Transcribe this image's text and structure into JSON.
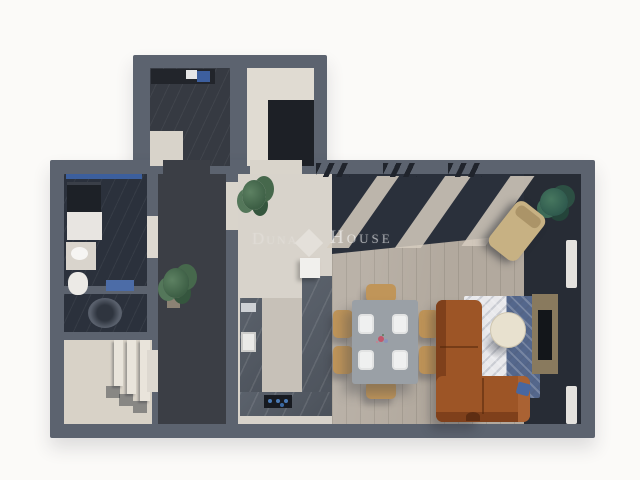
{
  "watermark": {
    "prefix_text": "Duna",
    "logo": "diamond-icon",
    "brand_text": "House"
  },
  "palette": {
    "background": "#fbfaf8",
    "wall": "#5c636f",
    "wood_floor": "#b2a99e",
    "dark_tile_floor": "#2b313c",
    "hallway_floor": "#3b3e45",
    "light_floor": "#d8d2c7",
    "kitchen_counter": "#565d66",
    "sofa_leather": "#9d5526",
    "rug_blue": "#54678c",
    "rug_white": "#e9e9ec",
    "chair_wood": "#c09559",
    "window_accent_blue": "#3c5f9d",
    "plant_green": "#4e7052"
  },
  "rooms": [
    "storage-room",
    "wardrobe-room",
    "bathroom",
    "wc",
    "entry-with-stairs",
    "hallway",
    "kitchen",
    "living-dining-area",
    "terrace-shadow-band"
  ],
  "furniture": [
    "washing-machine",
    "dryer",
    "bath-counter-sink",
    "toilet",
    "staircase",
    "potted-plants",
    "u-shaped-kitchen-counter",
    "kitchen-sink",
    "cooktop",
    "fridge",
    "dining-table",
    "six-dining-chairs",
    "four-place-settings",
    "l-shaped-sofa",
    "round-coffee-table",
    "patterned-area-rug",
    "tv-console",
    "lounge-chair",
    "radiators"
  ]
}
